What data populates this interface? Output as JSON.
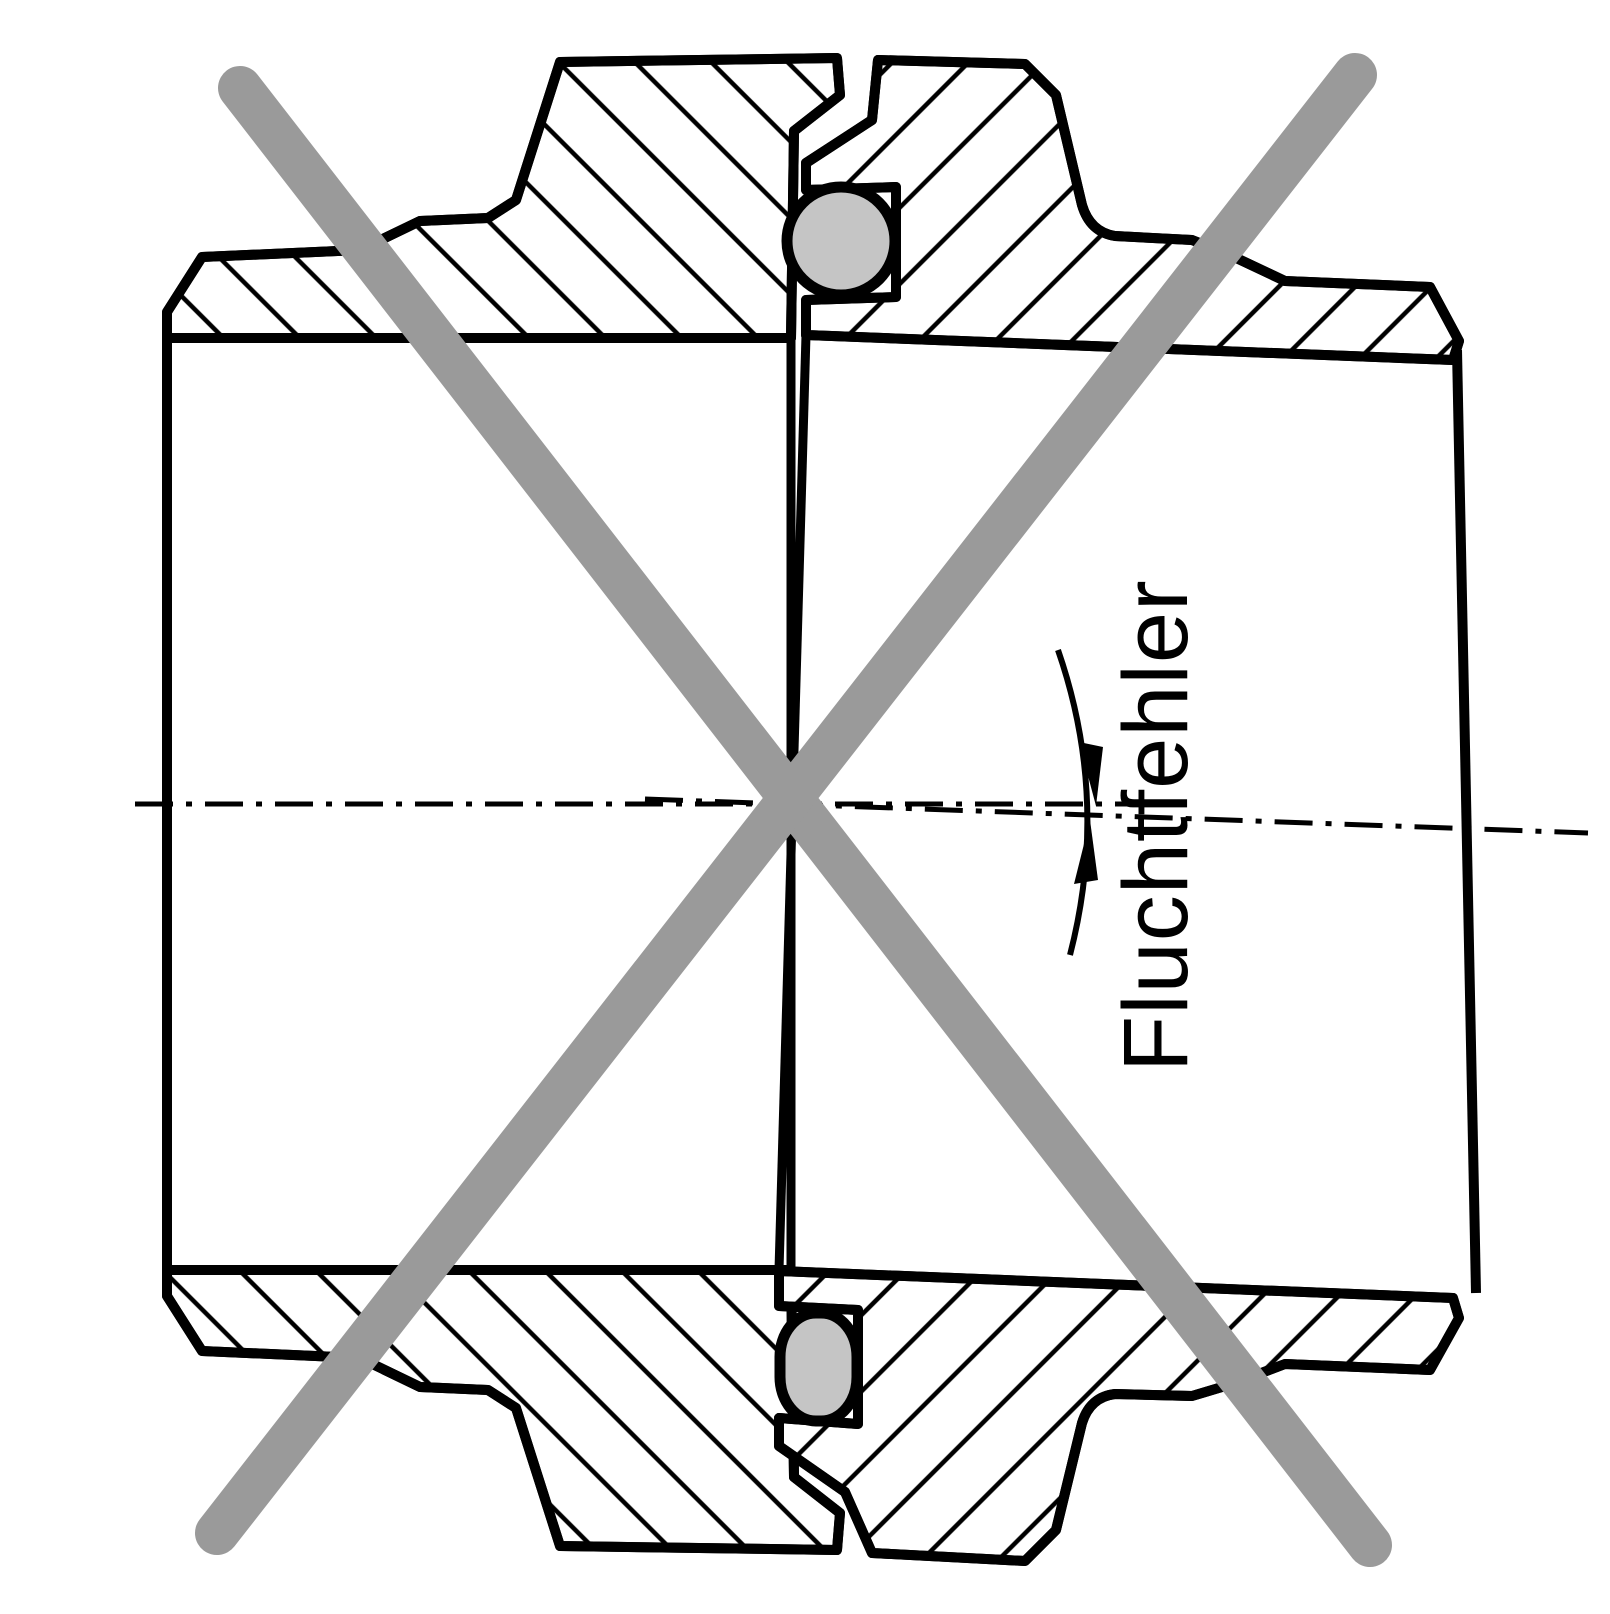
{
  "diagram": {
    "type": "technical-cross-section",
    "label": "Fluchtfehler",
    "label_orientation": "rotated-90-ccw",
    "colors": {
      "line": "#000000",
      "prohibition_cross": "#9a9a9a",
      "seal": "#c5c5c5",
      "background": "#ffffff"
    }
  }
}
